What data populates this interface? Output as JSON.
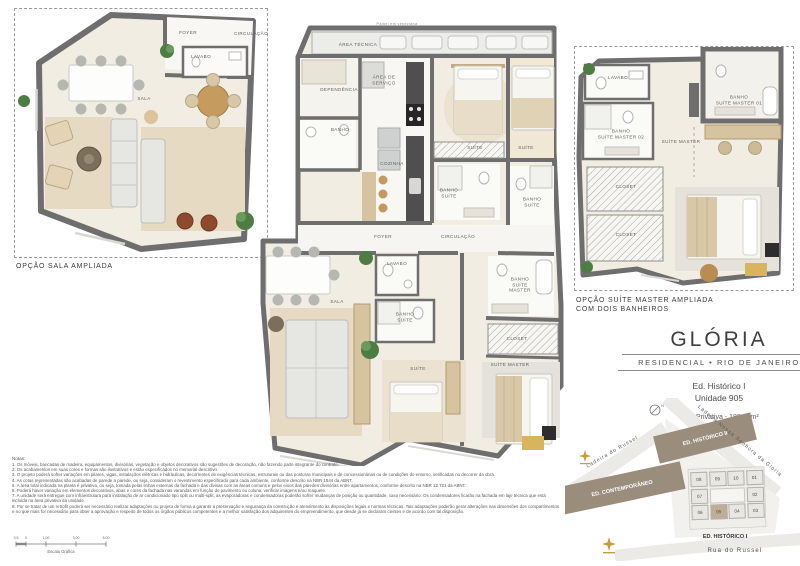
{
  "title_block": {
    "title": "GLÓRIA",
    "subtitle": "RESIDENCIAL • RIO DE JANEIRO",
    "building": "Ed. Histórico I",
    "unit": "Unidade 905",
    "area": "Área Privativa - 188,30m²"
  },
  "plans": {
    "sala_ampliada": {
      "caption": "OPÇÃO SALA AMPLIADA",
      "rooms": [
        {
          "label": "FOYER",
          "x": 173,
          "y": 24
        },
        {
          "label": "CIRCULAÇÃO",
          "x": 236,
          "y": 25
        },
        {
          "label": "LAVABO",
          "x": 186,
          "y": 48
        },
        {
          "label": "SALA",
          "x": 129,
          "y": 90
        }
      ]
    },
    "main": {
      "top_note": "Painel em veneziana",
      "rooms": [
        {
          "label": "ÁREA TÉCNICA",
          "x": 100,
          "y": 37
        },
        {
          "label": "DEPENDÊNCIA",
          "x": 81,
          "y": 82
        },
        {
          "label": "ÁREA DE\nSERVIÇO",
          "x": 126,
          "y": 72
        },
        {
          "label": "BANHO",
          "x": 82,
          "y": 122
        },
        {
          "label": "COZINHA",
          "x": 134,
          "y": 156
        },
        {
          "label": "SUÍTE",
          "x": 217,
          "y": 140
        },
        {
          "label": "SUÍTE",
          "x": 268,
          "y": 140
        },
        {
          "label": "BANHO\nSUÍTE",
          "x": 191,
          "y": 185
        },
        {
          "label": "BANHO\nSUÍTE",
          "x": 274,
          "y": 194
        },
        {
          "label": "FOYER",
          "x": 125,
          "y": 229
        },
        {
          "label": "CIRCULAÇÃO",
          "x": 200,
          "y": 229
        },
        {
          "label": "LAVABO",
          "x": 139,
          "y": 256
        },
        {
          "label": "SALA",
          "x": 79,
          "y": 294
        },
        {
          "label": "BANHO\nSUÍTE",
          "x": 147,
          "y": 309
        },
        {
          "label": "BANHO\nSUÍTE\nMASTER",
          "x": 262,
          "y": 277
        },
        {
          "label": "CLOSET",
          "x": 259,
          "y": 331
        },
        {
          "label": "SUÍTE",
          "x": 160,
          "y": 361
        },
        {
          "label": "SUÍTE MASTER",
          "x": 252,
          "y": 357
        }
      ]
    },
    "suite_master_ampliada": {
      "caption_line1": "OPÇÃO SUÍTE MASTER AMPLIADA",
      "caption_line2": "COM DOIS BANHEIROS",
      "rooms": [
        {
          "label": "LAVABO",
          "x": 43,
          "y": 31
        },
        {
          "label": "BANHO\nSUÍTE MASTER 01",
          "x": 164,
          "y": 53
        },
        {
          "label": "BANHO\nSUÍTE MASTER 02",
          "x": 46,
          "y": 87
        },
        {
          "label": "SUÍTE MASTER",
          "x": 106,
          "y": 95
        },
        {
          "label": "CLOSET",
          "x": 51,
          "y": 140
        },
        {
          "label": "CLOSET",
          "x": 51,
          "y": 188
        }
      ]
    }
  },
  "site_map": {
    "streets": [
      "Ladeira do Russel",
      "Ladeira  Nossa  Senhora  da  Glória",
      "Rua  do  Russel"
    ],
    "buildings": {
      "historico2": "ED. HISTÓRICO II",
      "contemporaneo": "ED. CONTEMPORÂNEO",
      "historico1": "ED. HISTÓRICO I"
    },
    "units": [
      "08",
      "09",
      "10",
      "01",
      "07",
      "02",
      "06",
      "05",
      "04",
      "03"
    ],
    "highlighted_unit": "05",
    "compass": "N"
  },
  "notes": {
    "title": "Notas:",
    "items": [
      "1. Os móveis, bancadas de madeira, equipamentos, divisórias, vegetação e objetos decorativos são sugestões de decoração, não fazendo parte integrante do contrato.",
      "2. Os acabamentos em suas cores e formas são ilustrativos e estão especificados no memorial descritivo.",
      "3. O projeto poderá sofrer variações em pilares, vigas, instalações elétricas e hidráulicas, decorrentes de exigências técnicas, estruturais ou das posturas municipais e de concessionárias ou de condições do entorno, verificadas no decorrer da obra.",
      "4. As cotas representadas são acabadas de parede a parede, ou seja, consideram o revestimento especificado para cada ambiente, conforme descrito na NBR 1544 da ABNT.",
      "5. A área total indicada na planta é privativa, ou seja, tomada pelas linhas externas da fachada e das divisas com as áreas comuns e pelos eixos das paredes divisórias entre apartamentos, conforme descrito na NBR 12.721 da ABNT.",
      "6. Poderá haver variação em elementos decorativos, abas e cores da fachada nas varandas em função do pavimento ou coluna, verificar imagens e/ou maquete.",
      "7. A unidade será entregue com infraestrutura para instalação de ar condicionado tipo split ou multi-split, as evaporadoras e condensadoras poderão sofrer mudanças de posição ou quantidade, caso necessário. Os condensadores ficarão na fachada em laje técnica que está incluída na área privativa da unidade.",
      "8. Por se tratar de um retrofit poderá ser necessário realizar adaptações no projeto de forma a garantir a preservação e segurança da construção e atendimento às disposições legais e normas técnicas. Tais adaptações poderão gerar alterações nas dimensões dos compartimentos e no que mais for necessário para obter a aprovação e respeito de todos os órgãos públicos competentes e a melhor satisfação dos adquirentes do empreendimento, que desde já se declaram cientes e de acordo com tal disposição."
    ]
  },
  "scale_bar": {
    "label": "Escala Gráfica",
    "ticks": [
      "0,5",
      "0",
      "1,00",
      "3,00",
      "5,00"
    ]
  },
  "colors": {
    "wall": "#6E6E6E",
    "floor": "#F1EDE3",
    "rug": "#E7DAC3",
    "building": "#9A8D7B",
    "unit_highlight": "#BFAE96",
    "accent_gold": "#C69C3E"
  }
}
